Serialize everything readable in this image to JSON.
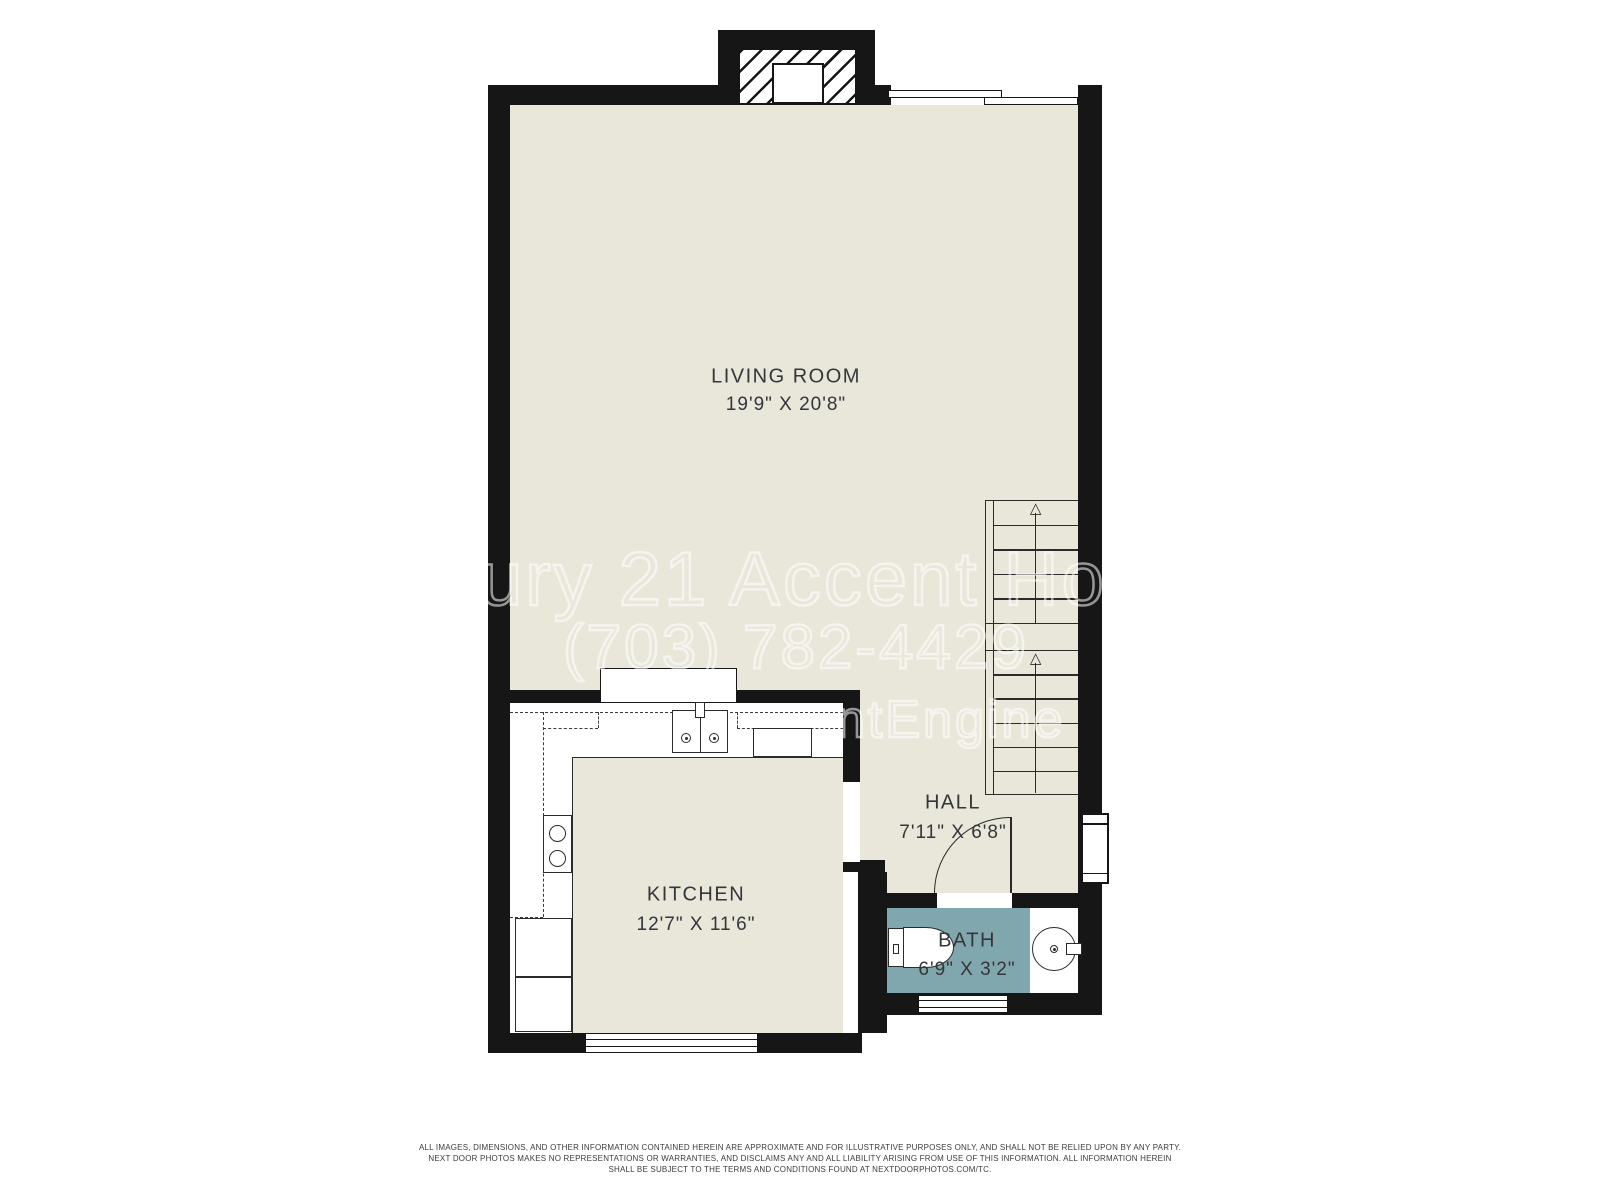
{
  "plan": {
    "rooms": {
      "living": {
        "name": "LIVING ROOM",
        "dims": "19'9\" X 20'8\""
      },
      "kitchen": {
        "name": "KITCHEN",
        "dims": "12'7\" X 11'6\""
      },
      "hall": {
        "name": "HALL",
        "dims": "7'11\" X 6'8\""
      },
      "bath": {
        "name": "BATH",
        "dims": "6'9\" X 3'2\""
      }
    }
  },
  "watermark": {
    "line1": "ury 21 Accent Ho",
    "line2": "(703) 782-4429",
    "line3": "ntEngine"
  },
  "disclaimer": {
    "line1": "ALL IMAGES, DIMENSIONS, AND OTHER INFORMATION CONTAINED HEREIN ARE APPROXIMATE AND FOR ILLUSTRATIVE PURPOSES ONLY, AND SHALL NOT BE RELIED UPON BY ANY PARTY.",
    "line2": "NEXT DOOR PHOTOS MAKES NO REPRESENTATIONS OR WARRANTIES, AND DISCLAIMS ANY AND ALL LIABILITY ARISING FROM USE OF THIS INFORMATION. ALL INFORMATION HEREIN",
    "line3": "SHALL BE SUBJECT TO THE TERMS AND CONDITIONS FOUND AT NEXTDOORPHOTOS.COM/TC."
  },
  "colors": {
    "floor": "#e9e6da",
    "bath": "#80a7ae",
    "wall": "#161616",
    "line": "#2b2b2b",
    "label": "#33363a"
  }
}
